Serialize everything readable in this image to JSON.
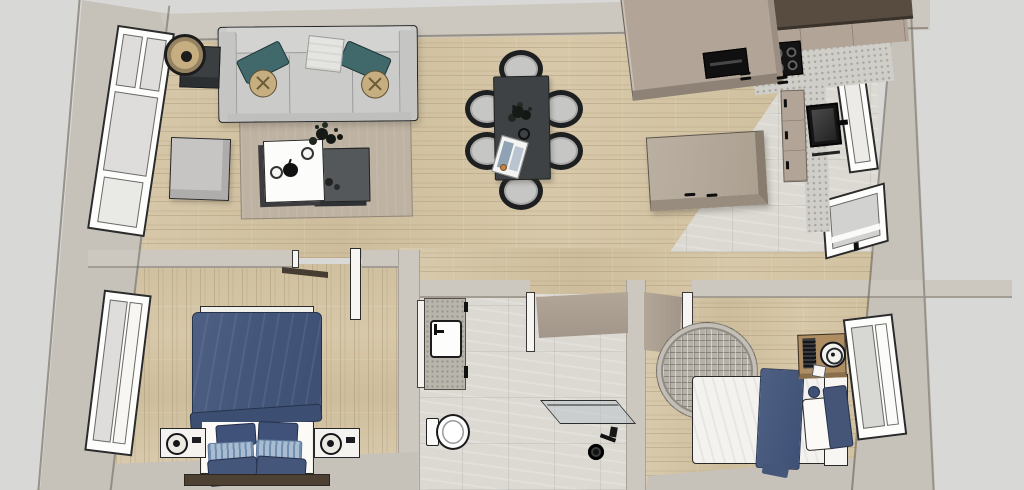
{
  "scene": {
    "type": "3d-floor-plan-top-down-render",
    "rooms": [
      {
        "id": "living-room",
        "objects": [
          "sofa",
          "teal-throw-pillow-left",
          "teal-throw-pillow-right",
          "round-tufted-pillow-left",
          "round-tufted-pillow-right",
          "throw-blanket",
          "floor-lamp",
          "dark-side-table",
          "square-ottoman",
          "beige-area-rug",
          "white-coffee-table",
          "dark-coffee-table",
          "decor-ring-small",
          "decor-ring-large",
          "black-apple-decor",
          "potted-plant",
          "decor-spheres",
          "tall-window"
        ]
      },
      {
        "id": "dining-area",
        "objects": [
          "charcoal-dining-table",
          "dining-chair-x6",
          "table-centerpiece-plant",
          "decor-ring",
          "open-magazine",
          "small-orange-bowl"
        ]
      },
      {
        "id": "kitchen",
        "objects": [
          "dark-brown-upper-cabinets",
          "taupe-cabinet-band",
          "speckled-countertop",
          "four-burner-cooktop",
          "peninsula-counter",
          "built-in-appliance",
          "cabinet-handles",
          "right-base-cabinets",
          "wall-mounted-screen",
          "floating-shelf",
          "kitchen-island",
          "entry-door",
          "small-window"
        ]
      },
      {
        "id": "bedroom-1",
        "objects": [
          "double-bed",
          "navy-duvet",
          "white-sheet",
          "navy-pillows",
          "striped-pillows",
          "dark-headboard",
          "nightstand-left",
          "nightstand-right",
          "table-lamp-left",
          "table-lamp-right",
          "vertical-window",
          "open-door",
          "closet-panel"
        ]
      },
      {
        "id": "bathroom",
        "objects": [
          "concrete-vanity",
          "white-sink",
          "black-faucet",
          "toilet",
          "walk-in-shower-glass",
          "shower-head",
          "shower-valve",
          "open-door",
          "door-jamb"
        ]
      },
      {
        "id": "bedroom-2",
        "objects": [
          "single-bed",
          "white-duvet",
          "navy-throw-blanket",
          "white-pillow",
          "navy-pillow",
          "round-cushion",
          "greek-key-round-rug",
          "wood-nightstand",
          "table-fan",
          "radio",
          "notecard",
          "side-window",
          "open-door",
          "door-jamb"
        ]
      }
    ]
  },
  "colors": {
    "exterior": "#d8d8d6",
    "wall_top": "#ccc7bf",
    "wall_face": "#c6c1b9",
    "wall_edge": "#97928a",
    "wood": "#d4c5a6",
    "tile": "#dcd9d3",
    "counter_speckle": "#d0cec8",
    "sofa_gray": "#cbcbc9",
    "pillow_teal": "#41686a",
    "pillow_tan": "#c7ae80",
    "rug_beige": "#beb2a2",
    "furniture_dark": "#3b3f42",
    "ct_white": "#fcfcfb",
    "ct_dark": "#55585a",
    "table_charcoal": "#3e4244",
    "chair_frame": "#1d1f20",
    "chair_seat": "#c6c6c4",
    "outline_dark": "#222326",
    "cabinet_brown": "#584c41",
    "cabinet_taupe": "#b2a597",
    "island_taupe": "#b3a799",
    "appliance_black": "#141414",
    "bed_navy": "#47597c",
    "bed_navy_deep": "#3c4e71",
    "pillow_stripe": "#a9bdd2",
    "headboard_brown": "#4d4134",
    "door_taupe": "#ab9f91",
    "jamb_white": "#f6f5f2",
    "window_frame": "#fdfdfb",
    "glass_gray": "#dedddc",
    "rug_gray": "#b5b1a9",
    "rug_gray_line": "#8f8b83",
    "nightstand_wood": "#ae8d62"
  }
}
